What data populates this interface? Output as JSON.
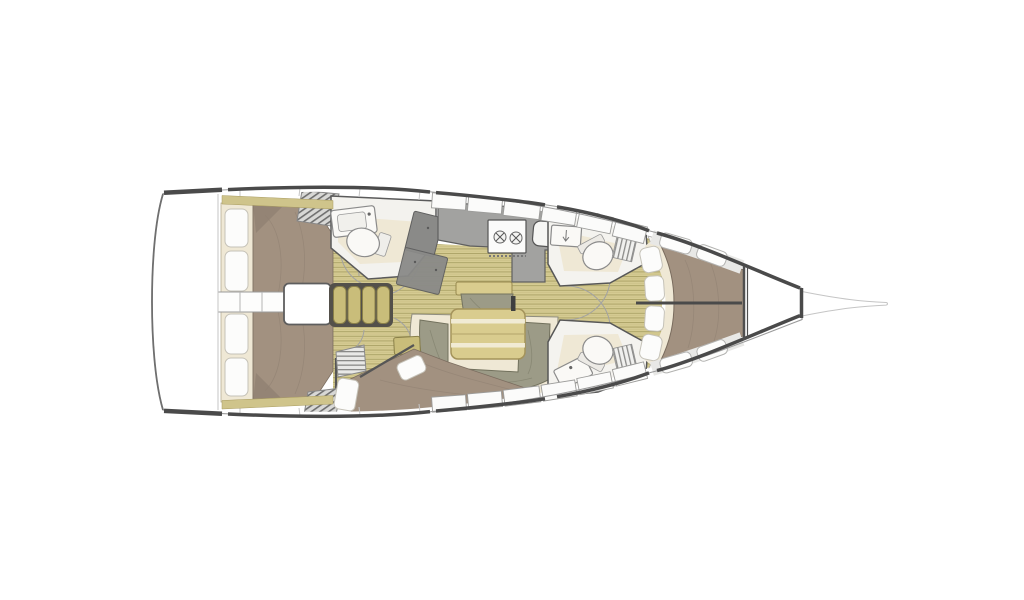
{
  "figure": {
    "kind": "sailing-yacht interior layout, top-down plan view",
    "orientation": "bow pointing right, stern at left"
  },
  "colors": {
    "background": "#ffffff",
    "hull_outline": "#8f8f8f",
    "hull_edge_dark": "#4a4a4a",
    "deck_panel": "#e8e8e6",
    "locker_white": "#fdfdfc",
    "floor_base": "#d5cb92",
    "floor_line": "#a39a5e",
    "bed": "#a29180",
    "bed_shadow": "#8f8071",
    "cream": "#efe8d5",
    "pillow": "#fcfcfb",
    "settee_khaki": "#c9bd7a",
    "wood_furniture": "#d9cc8e",
    "cushion_green": "#9c9b87",
    "counter_gray": "#a2a2a0",
    "steps_dark": "#8a8a88",
    "wall": "#565656"
  },
  "rooms": [
    {
      "name": "aft cabin port with double berth and pillows"
    },
    {
      "name": "aft cabin starboard with double berth and pillows"
    },
    {
      "name": "engine compartment between aft cabins"
    },
    {
      "name": "companionway louver panel"
    },
    {
      "name": "aft head with sink, toilet and shower steps"
    },
    {
      "name": "galley with two-burner stove and sink"
    },
    {
      "name": "salon with settees and table"
    },
    {
      "name": "mid cabin with angled double berth"
    },
    {
      "name": "forward head port side with toilet and sink"
    },
    {
      "name": "forward head starboard side with toilet and sink"
    },
    {
      "name": "forward owner cabin with V-berth and four pillows"
    },
    {
      "name": "anchor locker and bowsprit"
    }
  ]
}
